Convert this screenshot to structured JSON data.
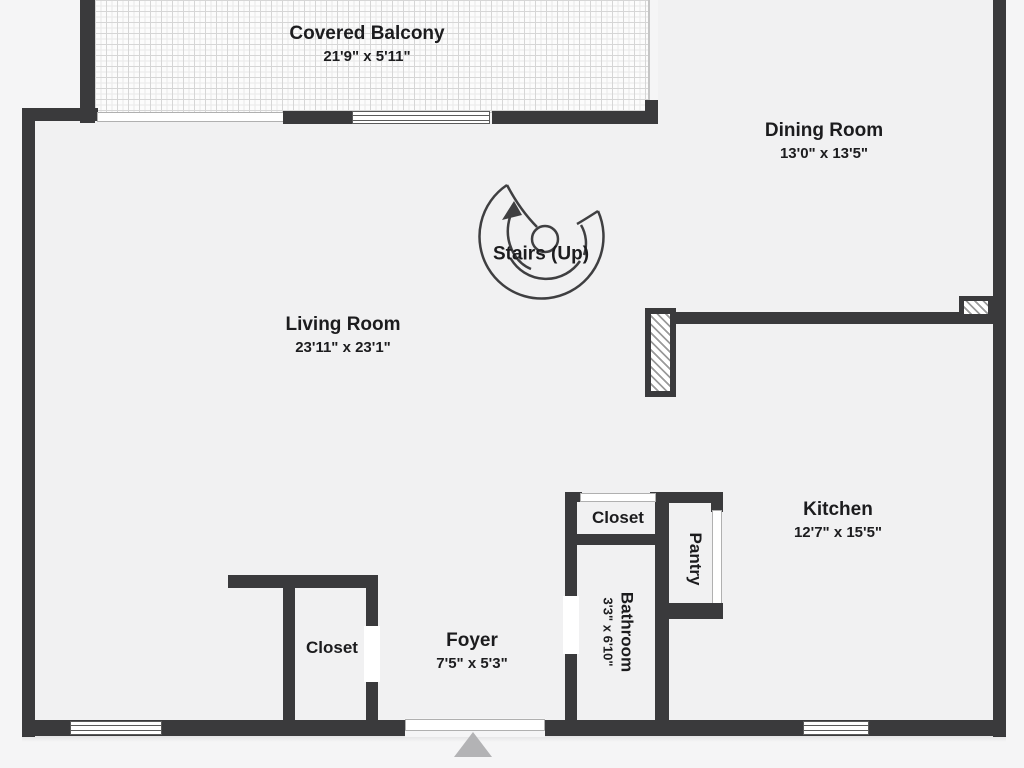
{
  "title": "Floor plan",
  "colors": {
    "wall": "#3a3a3c",
    "floor": "#f1f1f2",
    "outside": "#f5f5f6",
    "tile_line": "#d6d6d6",
    "window_frame": "#5a5a5a",
    "opening_line": "#b0b0b0",
    "hatch_line": "#9a9a9a",
    "entry_arrow": "#b3b3b5",
    "text": "#1c1c1e"
  },
  "icons": {
    "stairs": "spiral-stairs-icon",
    "entrance": "entrance-arrow-icon"
  },
  "rooms": {
    "balcony": {
      "name": "Covered Balcony",
      "dims": "21'9\" x 5'11\""
    },
    "dining": {
      "name": "Dining Room",
      "dims": "13'0\" x 13'5\""
    },
    "living": {
      "name": "Living Room",
      "dims": "23'11\" x 23'1\""
    },
    "stairs": {
      "name": "Stairs (Up)"
    },
    "kitchen": {
      "name": "Kitchen",
      "dims": "12'7\" x 15'5\""
    },
    "hall_closet": {
      "name": "Closet"
    },
    "pantry": {
      "name": "Pantry"
    },
    "bathroom": {
      "name": "Bathroom",
      "dims": "3'3\" x 6'10\""
    },
    "foyer_closet": {
      "name": "Closet"
    },
    "foyer": {
      "name": "Foyer",
      "dims": "7'5\" x 5'3\""
    }
  }
}
